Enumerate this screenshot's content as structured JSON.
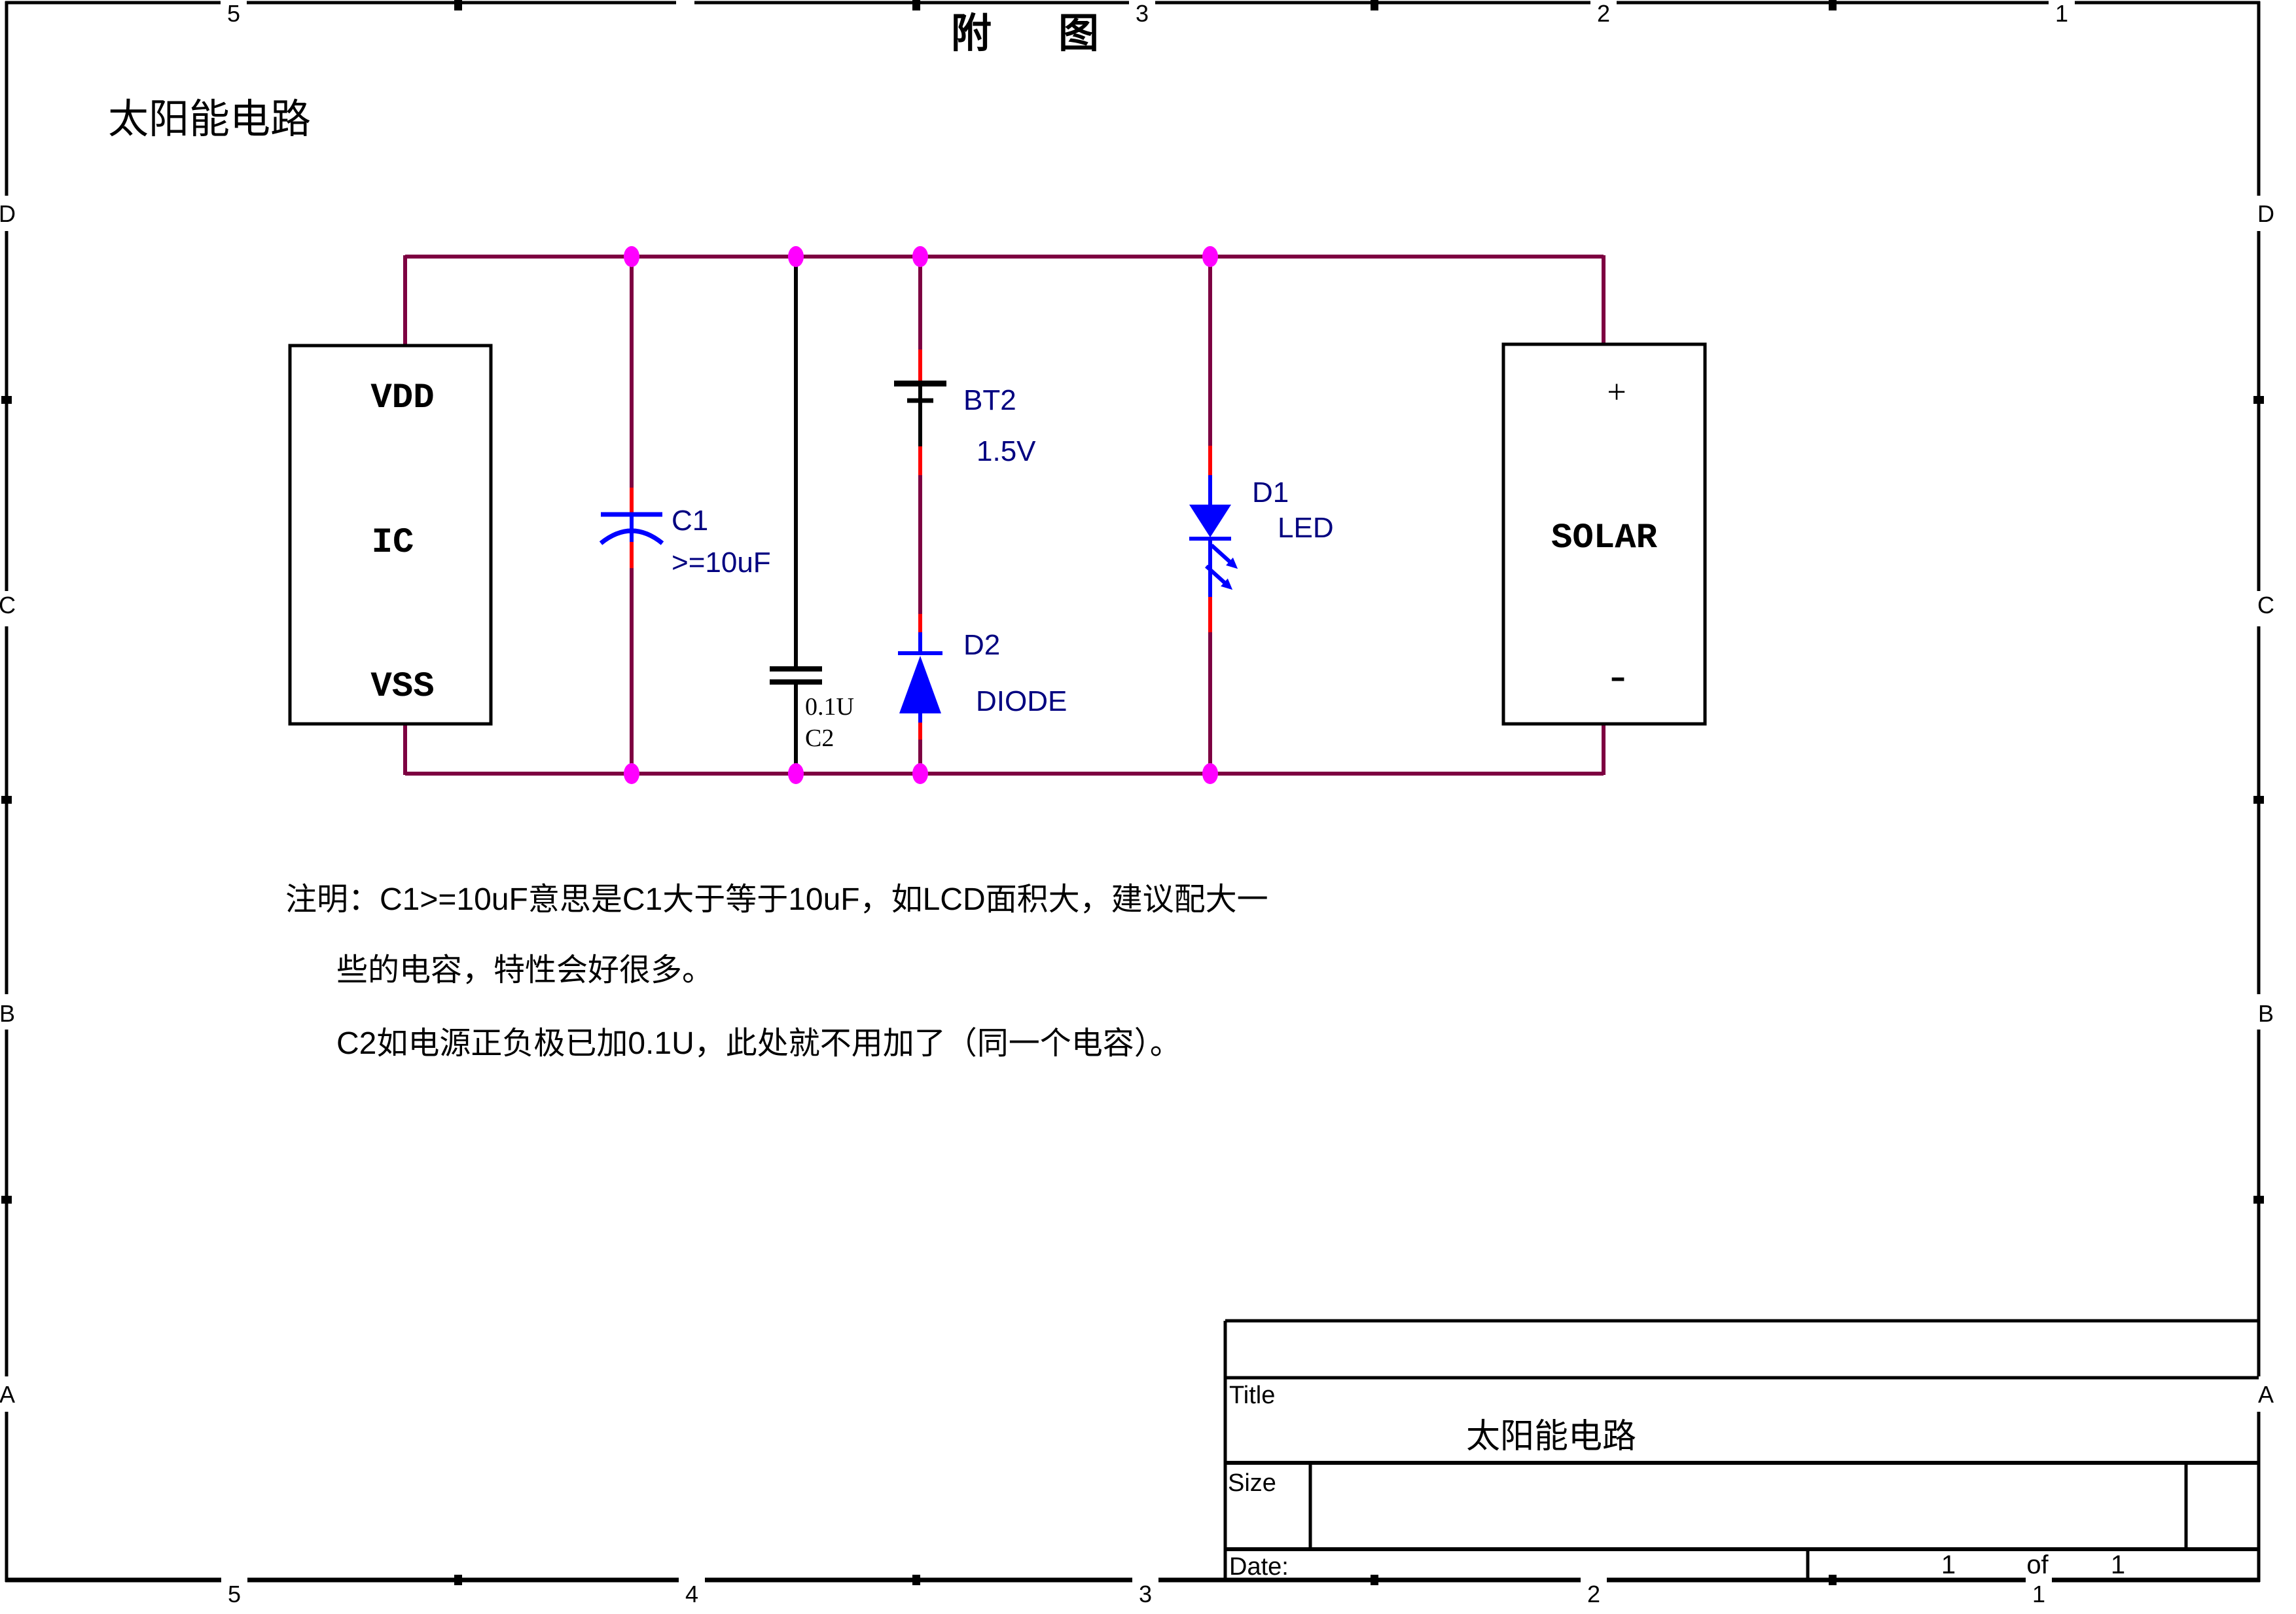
{
  "sheet": {
    "page_title": "附　图",
    "heading": "太阳能电路",
    "border_labels": {
      "top": [
        "5",
        "3",
        "2",
        "1"
      ],
      "bottom": [
        "5",
        "4",
        "3",
        "2",
        "1"
      ],
      "left": [
        "D",
        "C",
        "B",
        "A"
      ],
      "right": [
        "D",
        "C",
        "B",
        "A"
      ]
    }
  },
  "colors": {
    "wire": "#7D0041",
    "pin_red": "#FF0000",
    "symbol_blue": "#0000FF",
    "junction_magenta": "#FF00FF",
    "label_navy": "#000080",
    "black": "#000000",
    "background": "#ffffff"
  },
  "circuit": {
    "ic": {
      "pin_top": "VDD",
      "name": "IC",
      "pin_bottom": "VSS"
    },
    "solar": {
      "plus": "+",
      "name": "SOLAR",
      "minus": "-"
    },
    "c1": {
      "ref": "C1",
      "value": ">=10uF"
    },
    "c2": {
      "value": "0.1U",
      "ref": "C2"
    },
    "bt2": {
      "ref": "BT2",
      "value": "1.5V"
    },
    "d2": {
      "ref": "D2",
      "value": "DIODE"
    },
    "d1": {
      "ref": "D1",
      "value": "LED"
    }
  },
  "notes": {
    "line1": "注明：C1>=10uF意思是C1大于等于10uF，如LCD面积大，建议配大一",
    "line2": "些的电容，特性会好很多。",
    "line3": "C2如电源正负极已加0.1U，此处就不用加了（同一个电容）。"
  },
  "title_block": {
    "title_label": "Title",
    "title": "太阳能电路",
    "size_label": "Size",
    "date_label": "Date:",
    "sheet_page": "1",
    "sheet_of": "of",
    "sheet_total": "1"
  }
}
